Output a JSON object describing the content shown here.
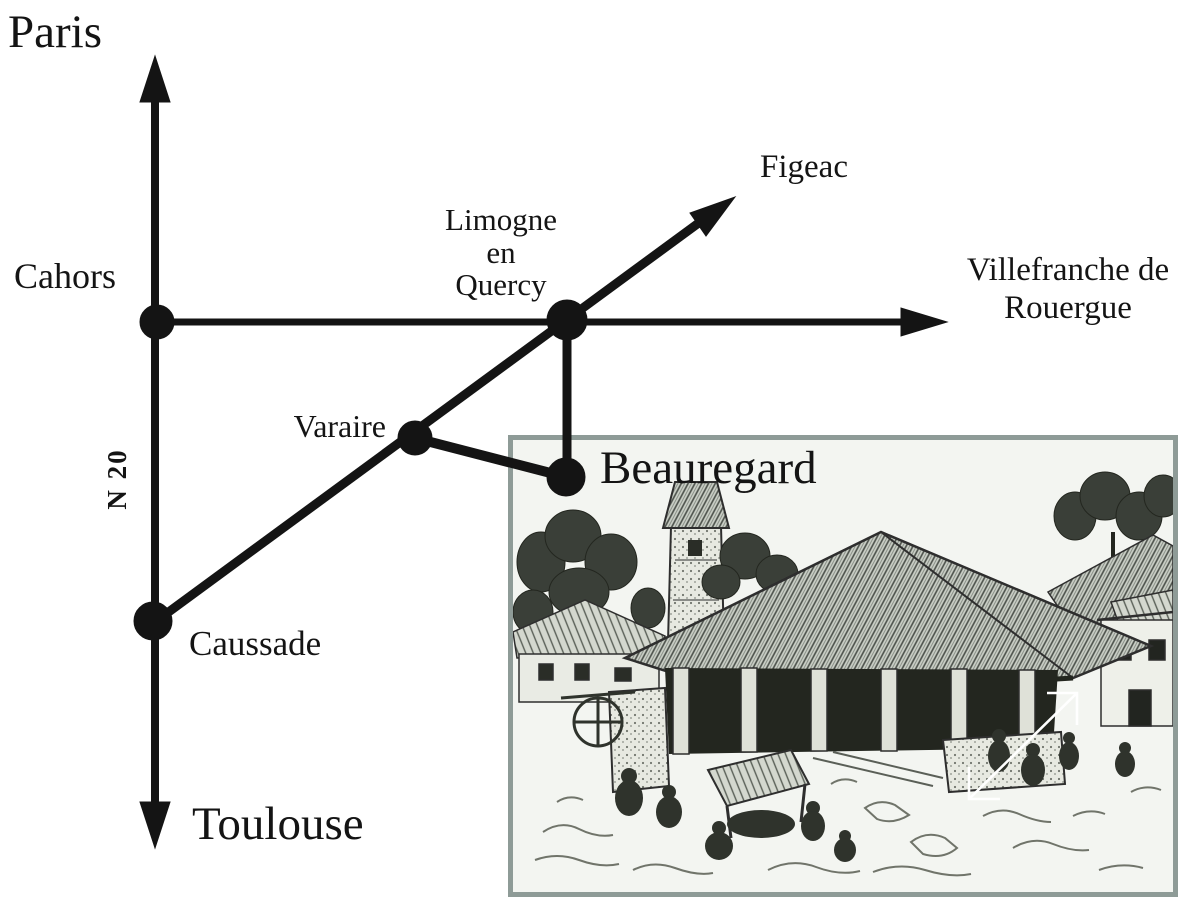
{
  "map": {
    "ink_color": "#141414",
    "road_label": "N 20",
    "destinations": {
      "paris": "Paris",
      "toulouse": "Toulouse",
      "figeac": "Figeac",
      "villefranche": [
        "Villefranche de",
        "Rouergue"
      ]
    },
    "towns": {
      "cahors": "Cahors",
      "limogne": [
        "Limogne",
        "en",
        "Quercy"
      ],
      "varaire": "Varaire",
      "beauregard": "Beauregard",
      "caussade": "Caussade"
    }
  },
  "illustration": {
    "subject": "village-market-hall-sketch",
    "frame_color": "#8e9b97",
    "paper_color": "#f3f5f1"
  }
}
